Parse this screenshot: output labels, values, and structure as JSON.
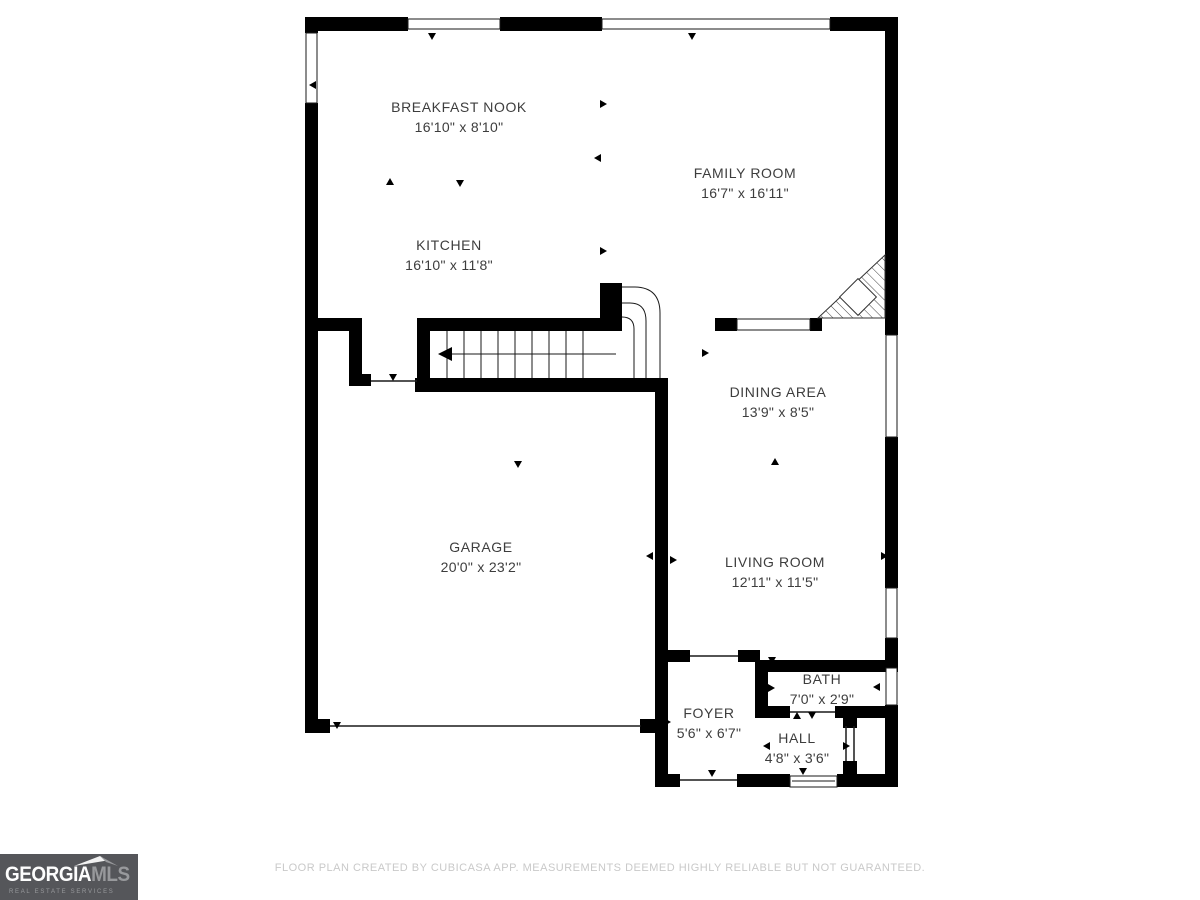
{
  "rooms": [
    {
      "name": "BREAKFAST NOOK",
      "dims": "16'10\" x 8'10\""
    },
    {
      "name": "FAMILY ROOM",
      "dims": "16'7\" x 16'11\""
    },
    {
      "name": "KITCHEN",
      "dims": "16'10\" x 11'8\""
    },
    {
      "name": "DINING AREA",
      "dims": "13'9\" x 8'5\""
    },
    {
      "name": "GARAGE",
      "dims": "20'0\" x 23'2\""
    },
    {
      "name": "LIVING ROOM",
      "dims": "12'11\" x 11'5\""
    },
    {
      "name": "FOYER",
      "dims": "5'6\" x 6'7\""
    },
    {
      "name": "BATH",
      "dims": "7'0\" x 2'9\""
    },
    {
      "name": "HALL",
      "dims": "4'8\" x 3'6\""
    }
  ],
  "footer": {
    "disclaimer": "FLOOR PLAN CREATED BY CUBICASA APP. MEASUREMENTS DEEMED HIGHLY RELIABLE BUT NOT GUARANTEED."
  },
  "logo": {
    "brand_primary": "GEORGIA",
    "brand_secondary": "MLS",
    "tagline": "REAL ESTATE SERVICES"
  },
  "colors": {
    "wall": "#000000",
    "room_text": "#3d3d3d",
    "footer_text": "#c9c9c9",
    "logo_bg": "#55565a"
  }
}
